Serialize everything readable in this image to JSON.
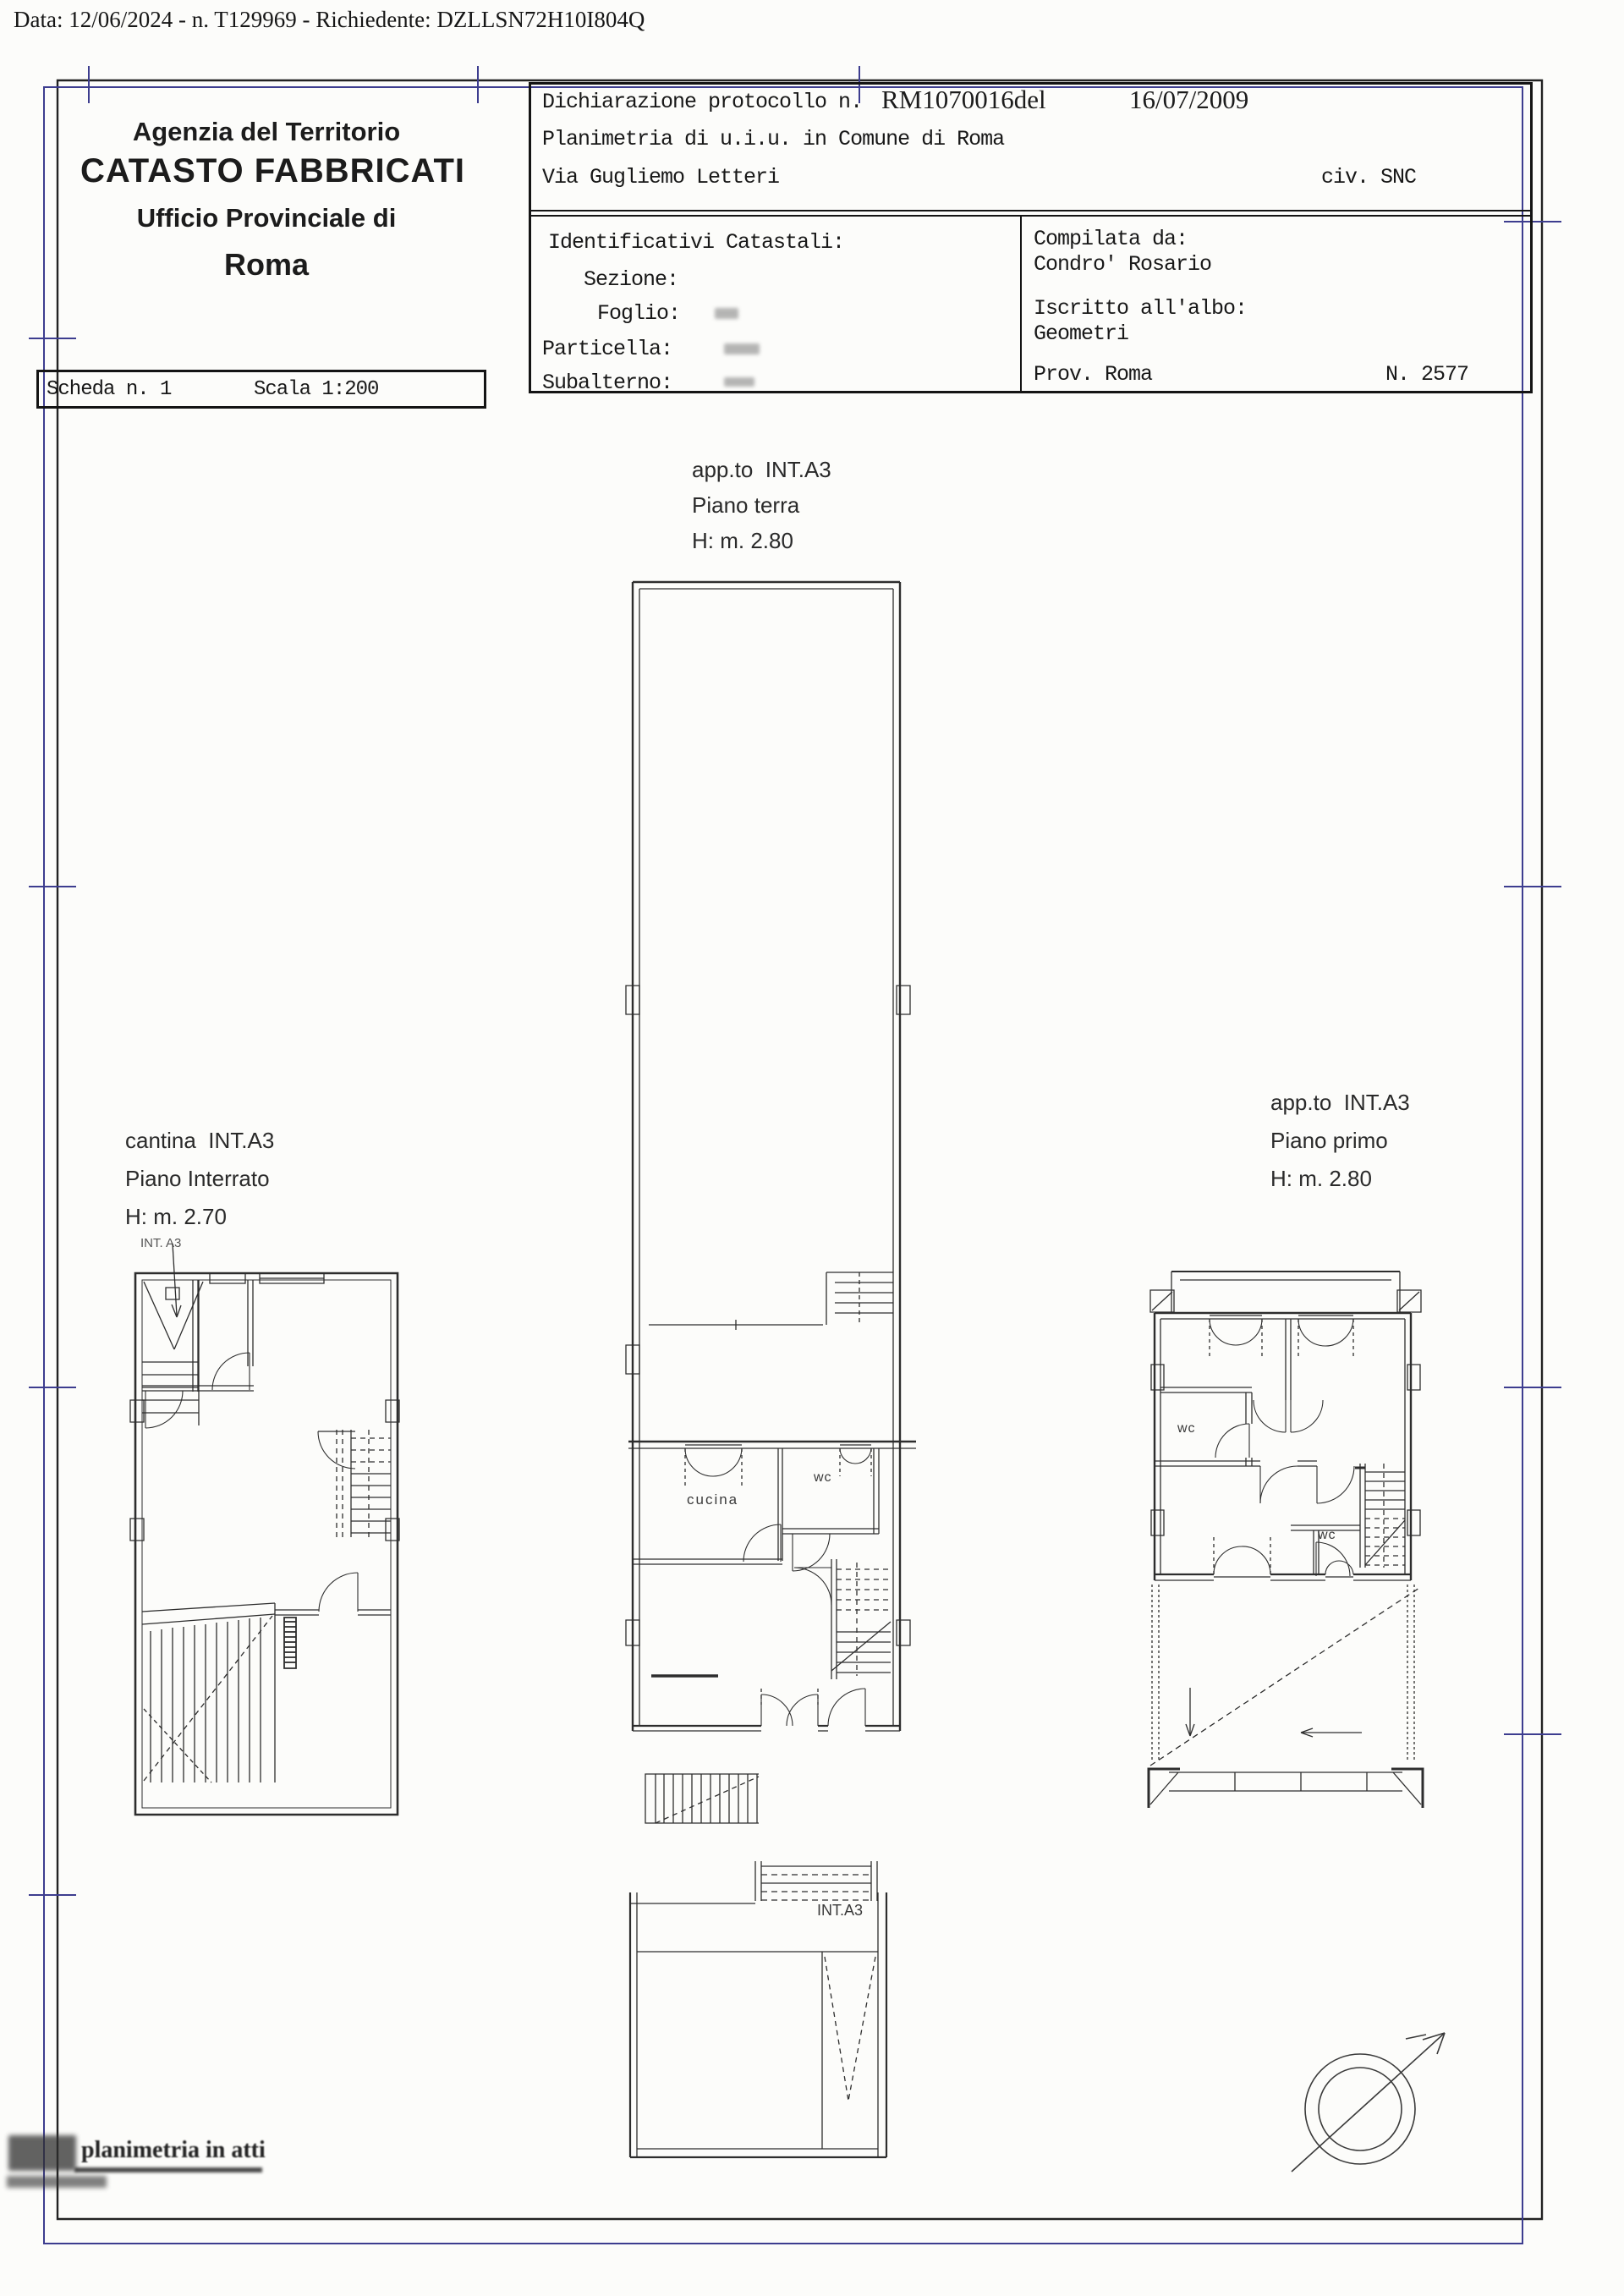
{
  "document": {
    "data_line": "Data: 12/06/2024 - n. T129969 - Richiedente: DZLLSN72H10I804Q"
  },
  "agency": {
    "line1": "Agenzia del Territorio",
    "line2": "CATASTO FABBRICATI",
    "line3": "Ufficio Provinciale di",
    "line4": "Roma"
  },
  "sheet": {
    "scheda": "Scheda n. 1",
    "scala": "Scala 1:200"
  },
  "declaration": {
    "protocol_label": "Dichiarazione protocollo n.",
    "protocol_number": "RM1070016del",
    "protocol_date": "16/07/2009",
    "planimetria_line": "Planimetria di u.i.u. in Comune di Roma",
    "street": "Via Gugliemo Letteri",
    "civic": "civ. SNC"
  },
  "catasto": {
    "title": "Identificativi Catastali:",
    "sezione": "Sezione:",
    "foglio": "Foglio:",
    "particella": "Particella:",
    "subalterno": "Subalterno:"
  },
  "compiler": {
    "title": "Compilata da:",
    "name": "Condro' Rosario",
    "albo_label": "Iscritto all'albo:",
    "albo_value": "Geometri",
    "prov": "Prov. Roma",
    "reg_number": "N. 2577"
  },
  "plans": {
    "basement": {
      "name": "cantina  INT.A3",
      "floor": "Piano Interrato",
      "height": "H: m. 2.70",
      "pointer_label": "INT. A3"
    },
    "ground": {
      "name": "app.to  INT.A3",
      "floor": "Piano terra",
      "height": "H: m. 2.80",
      "room_cucina": "cucina",
      "room_wc": "wc",
      "unit_label": "INT.A3"
    },
    "first": {
      "name": "app.to  INT.A3",
      "floor": "Piano primo",
      "height": "H: m. 2.80",
      "room_wc_upper": "wc",
      "room_wc_lower": "wc"
    }
  },
  "stamp": {
    "text": "planimetria in atti"
  },
  "colors": {
    "frame_blue": "#3d3d8f",
    "ink": "#1f1f1f"
  }
}
